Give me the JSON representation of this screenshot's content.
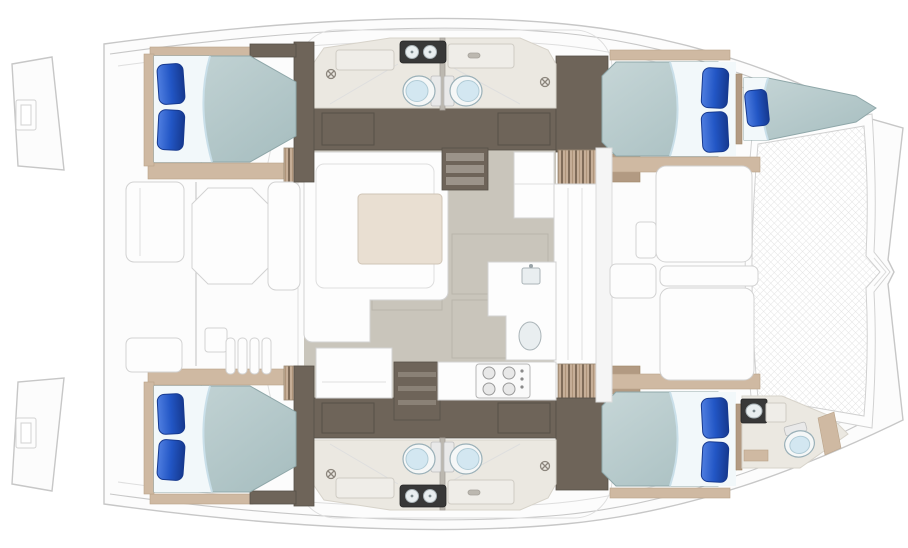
{
  "canvas": {
    "width": 908,
    "height": 548
  },
  "palette": {
    "background": "#ffffff",
    "hull-line": "#c7c7c7",
    "deck-white": "#fcfcfc",
    "furniture-white": "#fdfdfd",
    "furniture-line": "#d2d2d2",
    "floor-dark": "#6e6459",
    "floor-dark-line": "#575047",
    "wood-trim": "#cfb9a2",
    "wood-trim-dark": "#b29a82",
    "head-floor": "#ebe8e1",
    "head-wall": "#d7d3ca",
    "salon-floor": "#c9c5bb",
    "salon-floor-line": "#b9b5ab",
    "mattress-light": "#c6d6d7",
    "mattress-dark": "#a6bdbf",
    "mattress-edge": "#8fa7a9",
    "sheet": "#f2f8fa",
    "sheet-shadow": "#c9dfe9",
    "pillow-light": "#4f7ee0",
    "pillow": "#2256c5",
    "pillow-dark": "#16398f",
    "toilet-body": "#f5f7f7",
    "toilet-seat": "#d3e7f1",
    "counter-dark": "#383838",
    "table-beige": "#e9dfd2",
    "steps-tan": "#c6ae97",
    "steps-line": "#6e5c49",
    "mesh-line": "#e3e3e3"
  },
  "features": {
    "vessel": {
      "type": "catamaran deck plan",
      "view": "top-down",
      "bow": "right",
      "stern": "left"
    },
    "cabins": [
      {
        "name": "aft-cabin-upper",
        "bed": "double-berth",
        "pillows": 2
      },
      {
        "name": "aft-cabin-lower",
        "bed": "double-berth",
        "pillows": 2
      },
      {
        "name": "forward-cabin-upper",
        "bed": "double-berth",
        "pillows": 2
      },
      {
        "name": "forward-cabin-lower",
        "bed": "double-berth",
        "pillows": 2
      }
    ],
    "forepeak": [
      {
        "name": "forepeak-berth-upper",
        "bed": "single-berth",
        "pillows": 1
      },
      {
        "name": "forepeak-head-lower",
        "fixtures": [
          "toilet",
          "vanity-sink"
        ]
      }
    ],
    "heads": {
      "toilets": 5,
      "vanity-sinks": 5,
      "shower-drains": 4,
      "vanities": 2
    },
    "salon": {
      "settee": "l-shaped",
      "dinette-table": 1,
      "cabinet": 1,
      "companionway-steps": 2,
      "galley": {
        "stove-burners": 4,
        "sinks": 2,
        "counters": 2
      }
    },
    "cockpit": {
      "table": "octagonal",
      "benches": 3,
      "slatted-seat": 1,
      "side-deck-steps": 4
    },
    "foredeck": {
      "sunpads": 2,
      "seat-strip": 1,
      "side-table": 1
    },
    "trampoline": {
      "texture": "mesh-crosshatch"
    },
    "swim-platforms": 2,
    "boarding-ladders": 2
  }
}
